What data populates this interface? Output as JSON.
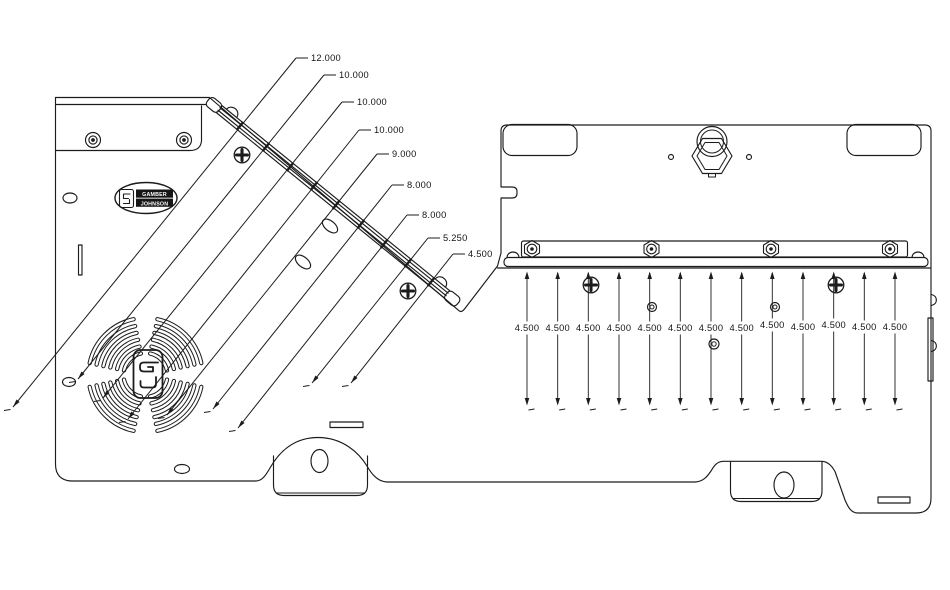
{
  "colors": {
    "line": "#1c1c1c",
    "background": "#ffffff"
  },
  "logo": {
    "brand_line1": "GAMBER",
    "brand_line2": "JOHNSON"
  },
  "callouts": {
    "labels": [
      "12.000",
      "10.000",
      "10.000",
      "10.000",
      "9.000",
      "8.000",
      "8.000",
      "5.250",
      "4.500"
    ]
  },
  "vertical_dimensions": {
    "labels": [
      "4.500",
      "4.500",
      "4.500",
      "4.500",
      "4.500",
      "4.500",
      "4.500",
      "4.500",
      "4.500",
      "4.500",
      "4.500",
      "4.500",
      "4.500"
    ]
  }
}
